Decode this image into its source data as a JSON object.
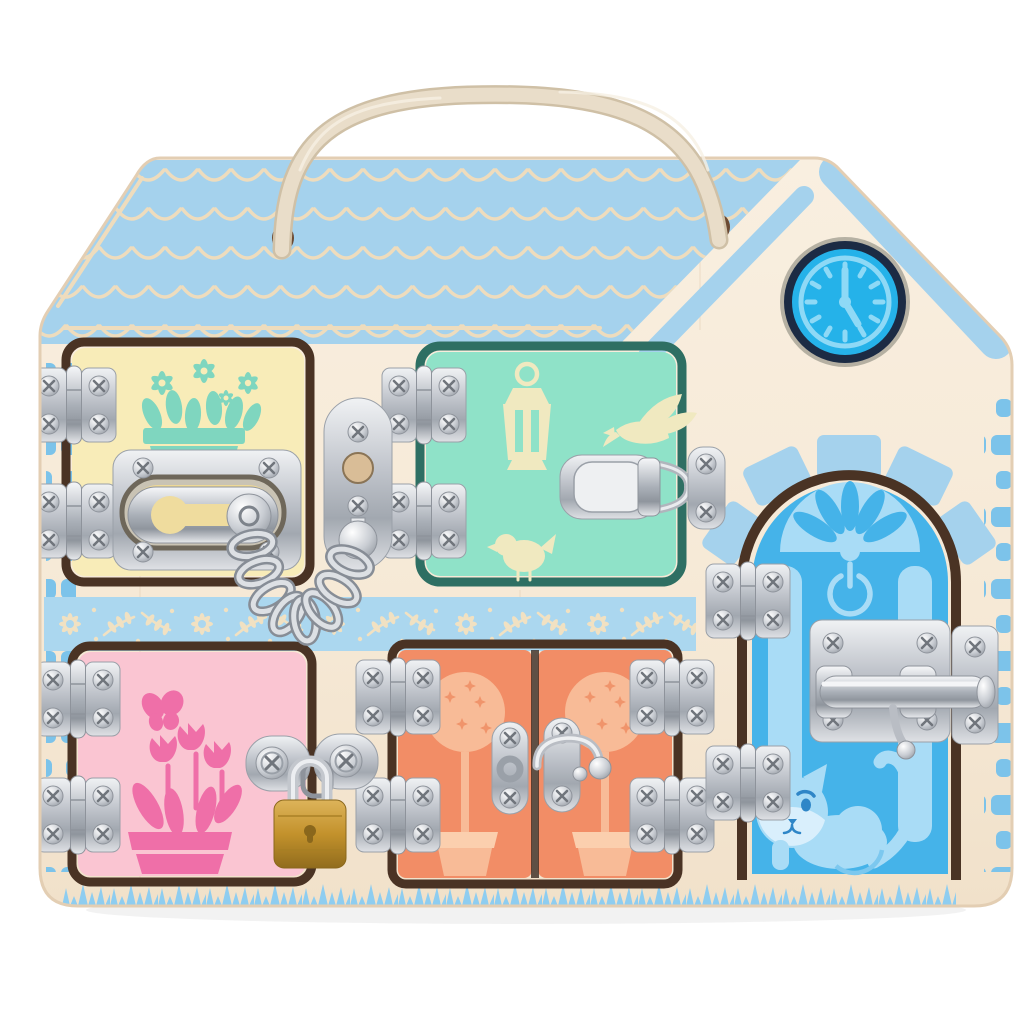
{
  "scene": {
    "background_color": "#ffffff",
    "description": "Wooden house-shaped busy board (latch and lock activity board) with a rope carry handle"
  },
  "colors": {
    "bg": "#ffffff",
    "wood": "#f7ecdc",
    "roof_blue": "#a5d2ed",
    "wave_cream": "#eedcbd",
    "brick_blue": "#7cc3ea",
    "band_blue": "#abd7ef",
    "band_cream": "#f1e1c2",
    "grass_blue": "#8ecdf0",
    "clock_ring": "#1c2b44",
    "clock_fill": "#25b2e9",
    "clock_light": "#8ed9f6",
    "door_yellow": "#f8ecb8",
    "motif_teal": "#7fd6bf",
    "door_mint": "#8fe2c8",
    "motif_cream": "#f0e9c0",
    "door_pink": "#fac5d2",
    "motif_pink": "#ef6fa8",
    "door_orange": "#f28d66",
    "motif_peach": "#f8bb97",
    "door_blue": "#45b3e9",
    "motif_lightblue": "#a9dcf6",
    "frame_dark": "#4a3324",
    "rope": "#e9ddc9",
    "rope_edge": "#cfc0a6",
    "hole": "#6b4a33",
    "brass": "#c99a33"
  },
  "board": {
    "shape": "house silhouette: slanted left roof edge, flat ridge, right gable slope",
    "rope_handle": {
      "present": true,
      "holes": 2
    },
    "roof": {
      "pattern": "scalloped shingle waves",
      "rows": 5
    },
    "clock": {
      "time": "5:00",
      "style": "printed toy clock face with tick marks"
    },
    "decorations": {
      "floral_band": "blue band with cream daisies and leaf sprigs across the middle",
      "grass_border": "blue grass fringe along the bottom",
      "brick_accents": "blue brick dashes on left and right edges",
      "stone_arch": "five blue stones fanned above the blue arched door"
    }
  },
  "doors": [
    {
      "name": "yellow-door",
      "position": "top-left",
      "color_key": "door_yellow",
      "motif": "window flower box with teal daisies",
      "hinge_count": 2,
      "lock": {
        "type": "swing-bar door guard with security chain"
      }
    },
    {
      "name": "mint-door",
      "position": "top-middle",
      "color_key": "door_mint",
      "motif": "lantern, flying bird and small bird",
      "hinge_count": 2,
      "lock": {
        "type": "spring toggle draw latch"
      }
    },
    {
      "name": "pink-door",
      "position": "bottom-left",
      "color_key": "door_pink",
      "motif": "tulips in a pot and a butterfly",
      "hinge_count": 2,
      "lock": {
        "type": "hasp with brass padlock"
      }
    },
    {
      "name": "orange-double-door",
      "position": "bottom-middle",
      "color_key": "door_orange",
      "motif": "two topiary trees in pots",
      "hinge_count": 4,
      "lock": {
        "type": "center swing hook latch"
      }
    },
    {
      "name": "blue-arched-door",
      "position": "right",
      "color_key": "door_blue",
      "motif": "fanlight, power symbol, side panels and a cat",
      "hinge_count": 2,
      "lock": {
        "type": "barrel slide bolt"
      }
    }
  ],
  "hardware": {
    "metal_finish": "polished silver",
    "chain_link_count": 8,
    "padlock_material": "brass"
  }
}
